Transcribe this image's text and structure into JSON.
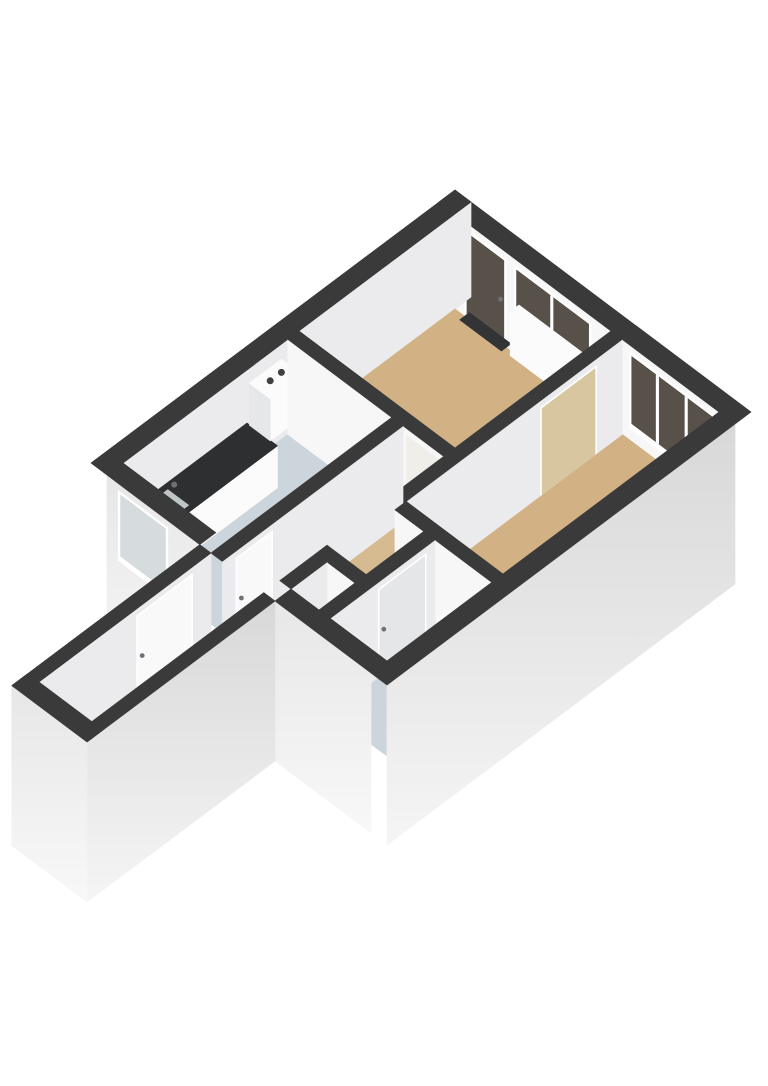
{
  "scene": {
    "kind": "isometric-3d-floorplan",
    "background": "#ffffff",
    "projection": {
      "ox": 455,
      "oy": 190,
      "k": 0.8,
      "m": 0.6
    },
    "wallHeight": 95,
    "slabDepth": 65
  },
  "palette": {
    "band": "#3a3a3b",
    "faceInU": "#ebebed",
    "faceInV": "#f7f7f8",
    "extUTop": "#d8d8d9",
    "extUBot": "#f5f5f5",
    "extVTop": "#e7e7e8",
    "extVBot": "#f8f8f8",
    "floorTan": "#d2b284",
    "floorTanL": "#d6ba90",
    "floorCool": "#ccd5db",
    "frame": "#ffffff",
    "glassDark": "#57514a",
    "glassLight": "#d6dbde",
    "white": "#fbfbfc",
    "shade": "#e6e7e9",
    "counterTop": "#2d2f31",
    "sink": "#bfc4c7",
    "dark": "#3f4042",
    "doorBeige": "#d8c6a0",
    "doorGray": "#e4e6e8",
    "leafWhite": "#f9f9fa",
    "handle": "#6f7275",
    "threshold": "#333436",
    "seeThroughUpper": "#f0eee8"
  },
  "rooms": [
    {
      "name": "living-room",
      "floor": "tan"
    },
    {
      "name": "bedroom",
      "floor": "tan"
    },
    {
      "name": "kitchen",
      "floor": "cool-gray"
    },
    {
      "name": "hall",
      "floor": "tan-light"
    },
    {
      "name": "entry-corridor",
      "floor": "tan-light"
    },
    {
      "name": "bathroom",
      "floor": "cool-gray"
    },
    {
      "name": "appliance-closet",
      "floor": "cool-gray"
    }
  ],
  "elements": [
    {
      "k": "wall",
      "n": "ne-exterior-wall",
      "r": [
        0,
        0,
        370,
        20
      ],
      "f": [
        "v"
      ],
      "cv": "faceInV",
      "ov": [
        {
          "n": "balcony-glass-door",
          "a": 32,
          "b": 84,
          "z0": 0,
          "z1": 88,
          "fill": "glassDark",
          "fw": 3,
          "ft": 3,
          "fb": 3,
          "handle": true
        },
        {
          "n": "living-room-window",
          "a": 94,
          "b": 190,
          "z0": 16,
          "z1": 88,
          "fill": "glassDark",
          "fw": 3,
          "ft": 3,
          "fb": 6,
          "m": [
            141
          ]
        },
        {
          "n": "bedroom-window",
          "a": 238,
          "b": 344,
          "z0": 12,
          "z1": 88,
          "fill": "glassDark",
          "fw": 3,
          "ft": 3,
          "fb": 6,
          "m": [
            273,
            309
          ]
        }
      ]
    },
    {
      "k": "wall",
      "n": "nw-exterior-wall",
      "r": [
        0,
        0,
        20,
        455
      ],
      "f": [
        "u"
      ],
      "cu": "faceInU"
    },
    {
      "k": "floor",
      "n": "living-room-floor",
      "r": [
        20,
        20,
        215,
        215
      ],
      "c": "floorTan"
    },
    {
      "k": "floor",
      "n": "bedroom-floor",
      "r": [
        229,
        20,
        350,
        290
      ],
      "c": "floorTan"
    },
    {
      "k": "floor",
      "n": "kitchen-floor",
      "r": [
        20,
        229,
        150,
        435
      ],
      "c": "floorCool"
    },
    {
      "k": "floorPoly",
      "n": "hall-floor",
      "pts": [
        [
          164,
          229
        ],
        [
          229,
          229
        ],
        [
          229,
          304
        ],
        [
          265,
          304
        ],
        [
          265,
          376
        ],
        [
          216,
          376
        ],
        [
          216,
          455
        ],
        [
          150,
          455
        ],
        [
          150,
          435
        ],
        [
          164,
          435
        ]
      ],
      "c": "floorTanL"
    },
    {
      "k": "floor",
      "n": "entry-corridor-floor",
      "r": [
        150,
        455,
        216,
        670
      ],
      "c": "floorTanL"
    },
    {
      "k": "floor",
      "n": "bathroom-floor",
      "r": [
        279,
        304,
        350,
        435
      ],
      "c": "floorCool"
    },
    {
      "k": "floor",
      "n": "closet-floor",
      "r": [
        230,
        390,
        265,
        435
      ],
      "c": "floorCool"
    },
    {
      "k": "flat",
      "n": "balcony-door-threshold",
      "r": [
        32,
        14,
        84,
        26
      ],
      "c": "threshold"
    },
    {
      "k": "flat",
      "n": "living-doorway-threshold",
      "r": [
        168,
        215,
        214,
        229
      ],
      "c": "threshold"
    },
    {
      "k": "flat",
      "n": "bedroom-door-threshold",
      "r": [
        215,
        52,
        229,
        122
      ],
      "c": "threshold"
    },
    {
      "k": "flat",
      "n": "kitchen-door-threshold",
      "r": [
        150,
        392,
        164,
        438
      ],
      "c": "threshold"
    },
    {
      "k": "flat",
      "n": "bathroom-door-threshold",
      "r": [
        265,
        315,
        279,
        375
      ],
      "c": "threshold"
    },
    {
      "k": "flat",
      "n": "front-door-threshold",
      "r": [
        136,
        478,
        150,
        548
      ],
      "c": "threshold"
    },
    {
      "k": "box",
      "n": "living-room-radiator",
      "r": [
        100,
        20,
        185,
        31
      ],
      "z0": 8,
      "z1": 52,
      "ct": "white",
      "cu": "shade",
      "cv": "white"
    },
    {
      "k": "box",
      "n": "kitchen-counter",
      "r": [
        20,
        280,
        58,
        430
      ],
      "z0": 0,
      "z1": 42,
      "ct": "counterTop",
      "cu": "white",
      "cv": "shade",
      "topInset": {
        "r": [
          26,
          385,
          52,
          418
        ],
        "c": "sink"
      },
      "dot": {
        "p": 30,
        "q": 381,
        "z": 47,
        "rr": 3,
        "c": "handle"
      }
    },
    {
      "k": "box",
      "n": "boiler-unit",
      "r": [
        20,
        237,
        46,
        277
      ],
      "z0": 38,
      "z1": 80,
      "ct": "white",
      "cu": "white",
      "cv": "shade",
      "dots": [
        {
          "p": 31,
          "q": 248,
          "z": 80,
          "rr": 3.5,
          "c": "dark"
        },
        {
          "p": 31,
          "q": 262,
          "z": 80,
          "rr": 3.5,
          "c": "dark"
        }
      ]
    },
    {
      "k": "wall",
      "n": "living-hall-wall",
      "r": [
        20,
        215,
        229,
        229
      ],
      "f": [
        "v"
      ],
      "cv": "faceInV",
      "ov": [
        {
          "n": "living-doorway",
          "a": 168,
          "b": 214,
          "z0": 0,
          "z1": 88,
          "fill": "floorTanL",
          "fill2": "seeThroughUpper",
          "split": 0.38,
          "fw": 0,
          "ft": 0,
          "fb": 0
        }
      ]
    },
    {
      "k": "wall",
      "n": "living-bedroom-wall",
      "r": [
        215,
        20,
        229,
        304
      ],
      "f": [
        "u"
      ],
      "cu": "faceInU",
      "ou": [
        {
          "n": "bedroom-door",
          "a": 52,
          "b": 122,
          "z0": 0,
          "z1": 88,
          "fill": "doorBeige",
          "fw": 2,
          "ft": 2,
          "fb": 0
        }
      ]
    },
    {
      "k": "wall",
      "n": "kitchen-hall-wall",
      "r": [
        150,
        229,
        164,
        455
      ],
      "f": [
        "u"
      ],
      "cu": "faceInU",
      "ou": [
        {
          "n": "kitchen-door",
          "a": 392,
          "b": 438,
          "z0": 0,
          "z1": 88,
          "fill": "leafWhite",
          "fw": 2,
          "ft": 2,
          "fb": 0,
          "handle": true
        }
      ]
    },
    {
      "k": "wall",
      "n": "closet-north-wall",
      "r": [
        216,
        376,
        280,
        390
      ],
      "f": [
        "v"
      ],
      "cv": "faceInV"
    },
    {
      "k": "wall",
      "n": "closet-west-wall",
      "r": [
        216,
        390,
        230,
        435
      ],
      "f": [
        "u"
      ],
      "cu": "faceInU"
    },
    {
      "k": "wall",
      "n": "bedroom-bathroom-wall",
      "r": [
        229,
        290,
        350,
        304
      ],
      "f": [
        "v"
      ],
      "cv": "faceInV"
    },
    {
      "k": "box",
      "n": "washing-machine",
      "r": [
        234,
        394,
        262,
        430
      ],
      "z0": 0,
      "z1": 58,
      "ct": "white",
      "cu": "shade",
      "cv": "white",
      "topInset": {
        "r": [
          239,
          400,
          257,
          424
        ],
        "c": "dark"
      }
    },
    {
      "k": "wall",
      "n": "bathroom-wall",
      "r": [
        265,
        304,
        279,
        435
      ],
      "f": [
        "u"
      ],
      "cu": "faceInU",
      "ou": [
        {
          "n": "bathroom-door",
          "a": 315,
          "b": 375,
          "z0": 0,
          "z1": 88,
          "fill": "doorGray",
          "fw": 2,
          "ft": 2,
          "fb": 0,
          "handle": true
        }
      ]
    },
    {
      "k": "box",
      "n": "washbasin",
      "r": [
        300,
        304,
        338,
        322
      ],
      "z0": 26,
      "z1": 40,
      "ct": "white",
      "cu": "shade",
      "cv": "white",
      "dot": {
        "p": 330,
        "q": 308,
        "z": 45,
        "rr": 2.5,
        "c": "handle"
      }
    },
    {
      "k": "box",
      "n": "toilet-tank",
      "r": [
        286,
        424,
        303,
        433
      ],
      "z0": 0,
      "z1": 30,
      "ct": "white",
      "cu": "shade",
      "cv": "white"
    },
    {
      "k": "ellipse",
      "n": "toilet-bowl",
      "p": 294,
      "q": 416,
      "z": 18,
      "rx": 13,
      "ry": 8.5,
      "c": "white",
      "stroke": "#d3d5d6"
    },
    {
      "k": "wall",
      "n": "kitchen-exterior-wall",
      "r": [
        20,
        435,
        136,
        455
      ],
      "f": [
        "v"
      ],
      "cv": "extV",
      "slab": true,
      "ov": [
        {
          "n": "kitchen-window",
          "a": 34,
          "b": 96,
          "z0": 18,
          "z1": 88,
          "fill": "glassLight",
          "fw": 3,
          "ft": 3,
          "fb": 6
        }
      ]
    },
    {
      "k": "wall",
      "n": "south-exterior-wall",
      "r": [
        230,
        435,
        350,
        455
      ],
      "f": [
        "v"
      ],
      "cv": "extV",
      "slab": true
    },
    {
      "k": "wall",
      "n": "se-exterior-wall",
      "r": [
        350,
        20,
        370,
        455
      ],
      "f": [
        "u"
      ],
      "cu": "extU",
      "slab": true
    },
    {
      "k": "wall",
      "n": "corridor-nw-wall",
      "r": [
        136,
        455,
        150,
        690
      ],
      "f": [
        "u"
      ],
      "cu": "faceInU",
      "ou": [
        {
          "n": "front-door",
          "a": 478,
          "b": 548,
          "z0": 0,
          "z1": 88,
          "fill": "leafWhite",
          "fw": 2,
          "ft": 2,
          "fb": 0,
          "handle": true
        }
      ]
    },
    {
      "k": "wall",
      "n": "corridor-se-wall",
      "r": [
        216,
        455,
        230,
        690
      ],
      "f": [
        "u"
      ],
      "cu": "extU",
      "slab": true
    },
    {
      "k": "wall",
      "n": "corridor-end-wall",
      "r": [
        136,
        670,
        230,
        690
      ],
      "f": [
        "v"
      ],
      "cv": "extV",
      "slab": true
    }
  ]
}
